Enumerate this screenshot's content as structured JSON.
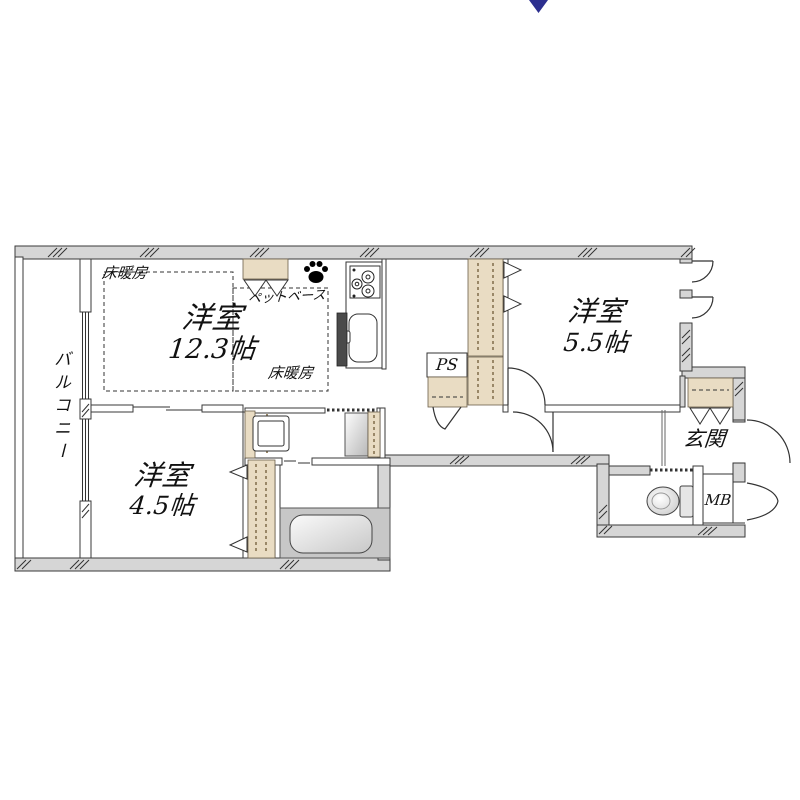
{
  "compass": {
    "direction_symbol": "▼"
  },
  "colors": {
    "wall_fill": "#d6d6d6",
    "closet_fill": "#e9dcc3",
    "compass_navy": "#2c2f8f",
    "bath_gray": "#c7c7c7"
  },
  "rooms": {
    "balcony": {
      "label": "バルコニー"
    },
    "living": {
      "name": "洋室",
      "size": "12.3帖"
    },
    "bedroom_5_5": {
      "name": "洋室",
      "size": "5.5帖"
    },
    "bedroom_4_5": {
      "name": "洋室",
      "size": "4.5帖"
    },
    "entrance": {
      "label": "玄関"
    }
  },
  "labels": {
    "floor_heating_top": "床暖房",
    "floor_heating_bottom": "床暖房",
    "pet_base": "ペットベース",
    "pipe_space": "PS",
    "meter_box": "MB"
  }
}
